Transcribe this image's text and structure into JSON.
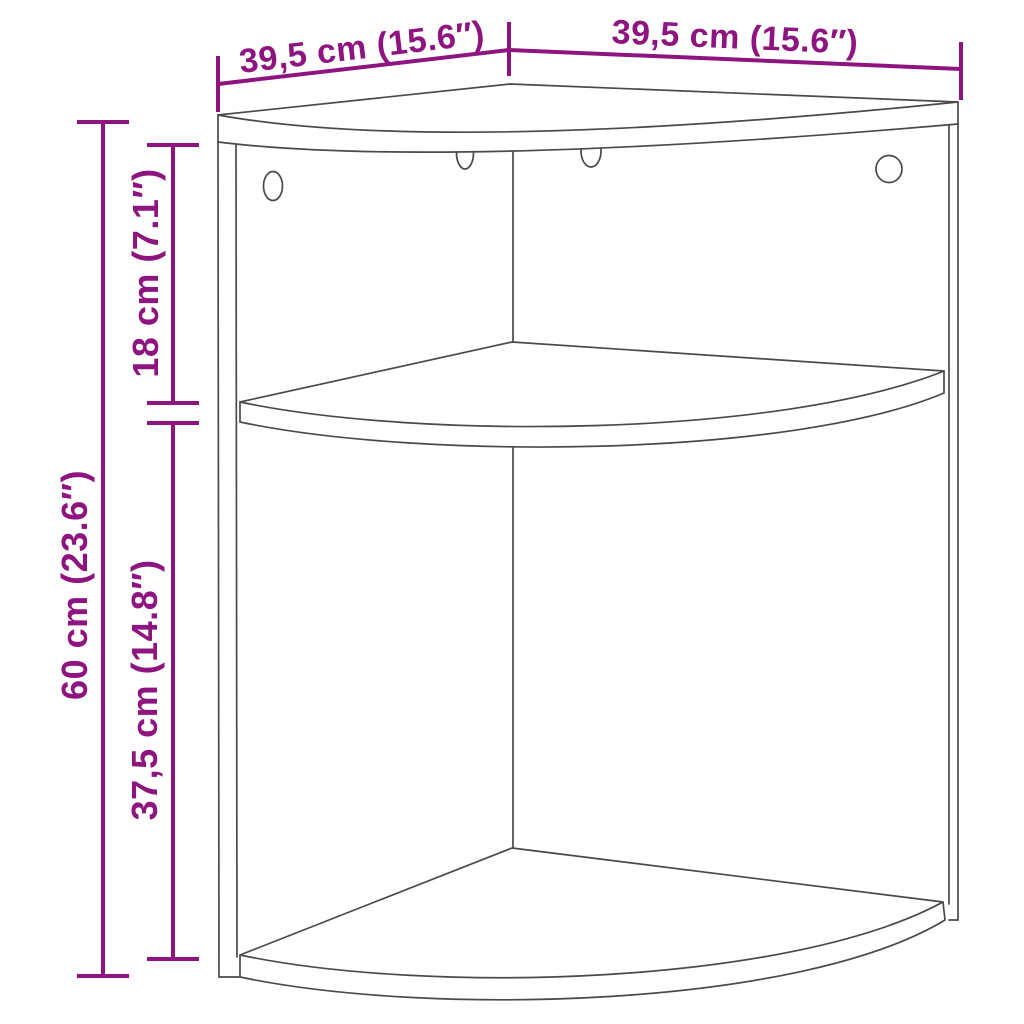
{
  "diagram": {
    "title": "Corner shelf cabinet dimension drawing",
    "product": "corner-shelf-unit",
    "colors": {
      "annotation": "#8E1480",
      "line_art": "#4A4A4A",
      "background": "#FFFFFF"
    },
    "dimensions": {
      "top_left_depth": "39,5 cm (15.6″)",
      "top_right_width": "39,5 cm (15.6″)",
      "overall_height": "60 cm (23.6″)",
      "upper_compartment_height": "18 cm (7.1″)",
      "lower_compartment_height": "37,5 cm (14.8″)"
    }
  }
}
